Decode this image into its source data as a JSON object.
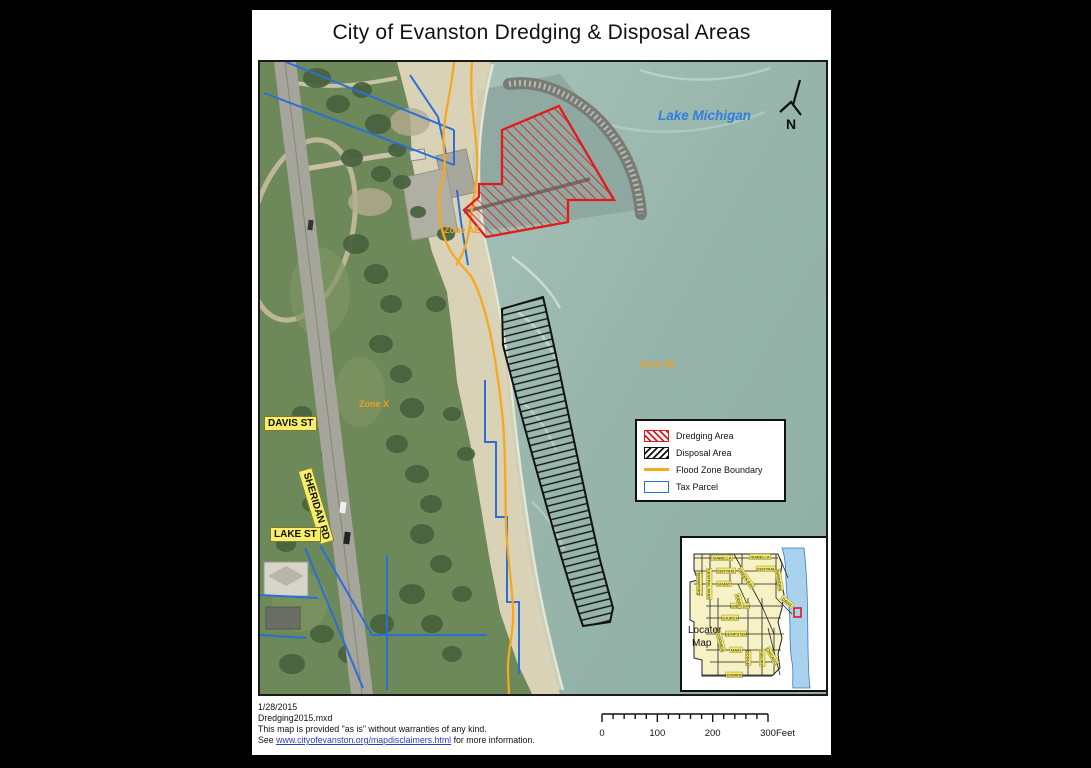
{
  "page": {
    "title": "City of Evanston Dredging & Disposal Areas"
  },
  "map": {
    "labels": {
      "lake": "Lake Michigan",
      "zone_ae_harbor": "Zone AE",
      "zone_ae_lake": "Zone AE",
      "zone_x": "Zone X",
      "davis_st": "DAVIS ST",
      "sheridan_rd": "SHERIDAN RD",
      "lake_st": "LAKE ST",
      "north": "N"
    },
    "colors": {
      "dredging": "#e31a1c",
      "disposal": "#111111",
      "flood_zone": "#f6a821",
      "tax_parcel": "#2a6fd6",
      "zone_text": "#f0a020",
      "lake_text": "#2f7fe0",
      "street_chip": "#f7ef6a"
    }
  },
  "legend": {
    "items": [
      {
        "label": "Dredging Area"
      },
      {
        "label": "Disposal Area"
      },
      {
        "label": "Flood Zone Boundary"
      },
      {
        "label": "Tax Parcel"
      }
    ]
  },
  "locator": {
    "title_line1": "Locator",
    "title_line2": "Map",
    "streets": [
      {
        "t": "ISABELLA",
        "x": 40,
        "y": 20,
        "r": 0
      },
      {
        "t": "ISABELLA",
        "x": 78,
        "y": 19,
        "r": 0
      },
      {
        "t": "CENTRAL",
        "x": 44,
        "y": 33,
        "r": 0
      },
      {
        "t": "CENTRAL",
        "x": 84,
        "y": 31,
        "r": 0
      },
      {
        "t": "GRANT",
        "x": 42,
        "y": 46,
        "r": 0
      },
      {
        "t": "EMERSON",
        "x": 58,
        "y": 68,
        "r": 0
      },
      {
        "t": "CHURCH",
        "x": 48,
        "y": 80,
        "r": 0
      },
      {
        "t": "DEMPSTER",
        "x": 54,
        "y": 96,
        "r": 0
      },
      {
        "t": "MAIN",
        "x": 54,
        "y": 112,
        "r": 0
      },
      {
        "t": "HOWARD",
        "x": 52,
        "y": 137,
        "r": 0
      },
      {
        "t": "CRAWFORD",
        "x": 17,
        "y": 46,
        "r": 90
      },
      {
        "t": "CENTRAL PARK",
        "x": 27,
        "y": 46,
        "r": 90
      },
      {
        "t": "GREEN BAY",
        "x": 64,
        "y": 40,
        "r": 55
      },
      {
        "t": "RIDGE",
        "x": 57,
        "y": 63,
        "r": 75
      },
      {
        "t": "SHERIDAN",
        "x": 97,
        "y": 42,
        "r": 80
      },
      {
        "t": "DAVIS",
        "x": 105,
        "y": 64,
        "r": 40
      },
      {
        "t": "McCORMICK",
        "x": 38,
        "y": 102,
        "r": 75
      },
      {
        "t": "DODGE",
        "x": 66,
        "y": 120,
        "r": 90
      },
      {
        "t": "ASBURY",
        "x": 80,
        "y": 120,
        "r": 90
      },
      {
        "t": "CHICAGO",
        "x": 90,
        "y": 118,
        "r": 60
      }
    ]
  },
  "scalebar": {
    "tick_labels": [
      "0",
      "100",
      "200",
      "300"
    ],
    "unit": "Feet",
    "intervals": 15
  },
  "footer": {
    "line1": "1/28/2015",
    "line2": "Dredging2015.mxd",
    "line3": "This map is provided \"as is\" without warranties of any kind.",
    "line4_prefix": "See ",
    "line4_link": "www.cityofevanston.org/mapdisclaimers.html",
    "line4_suffix": " for more information."
  }
}
